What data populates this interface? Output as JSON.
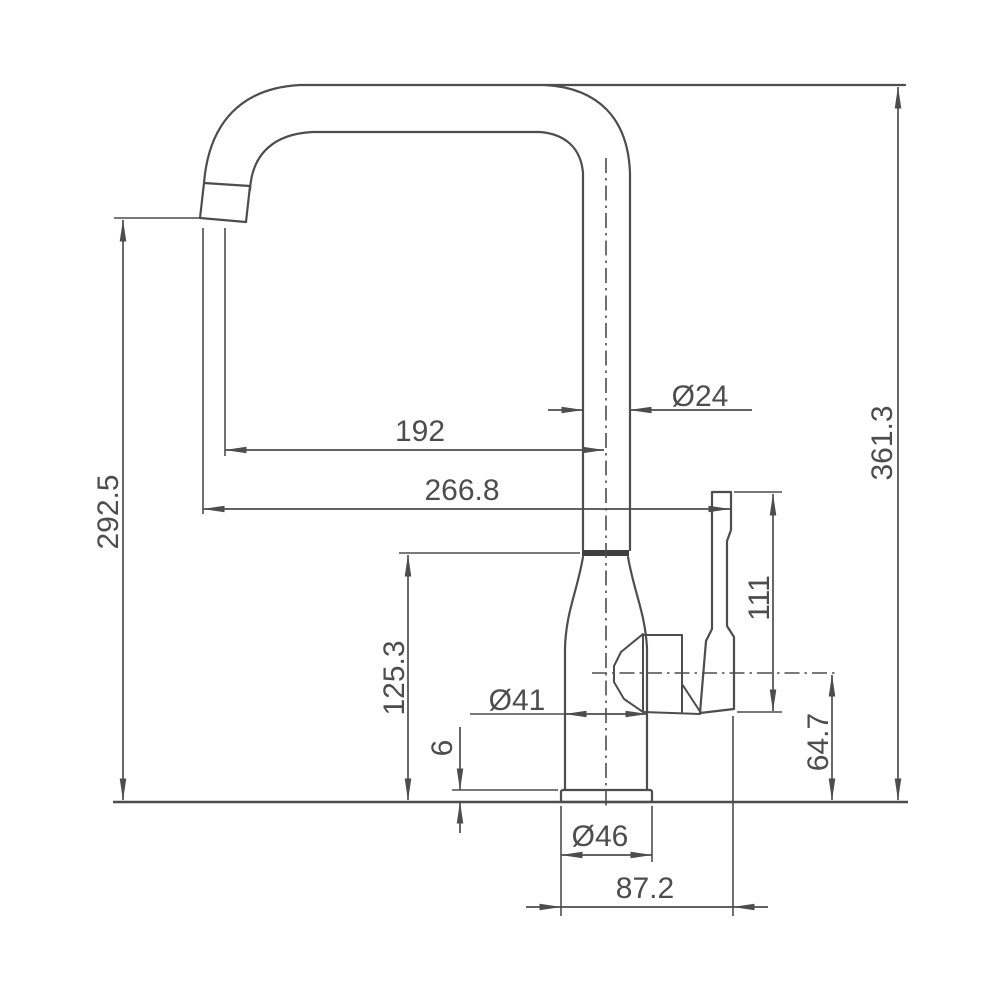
{
  "page": {
    "background": "#ffffff",
    "line_color": "#4d4d4d",
    "description": "Technical dimension drawing of a single-lever kitchen faucet, side view"
  },
  "dimensions": {
    "spout_height": "292.5",
    "overall_height": "361.3",
    "spout_reach": "192",
    "overall_reach": "266.8",
    "spout_pipe_diameter": "Ø24",
    "body_height": "125.3",
    "body_diameter": "Ø41",
    "base_plate_thickness": "6",
    "handle_length": "111",
    "handle_axis_height": "64.7",
    "base_diameter": "Ø46",
    "base_span": "87.2"
  }
}
